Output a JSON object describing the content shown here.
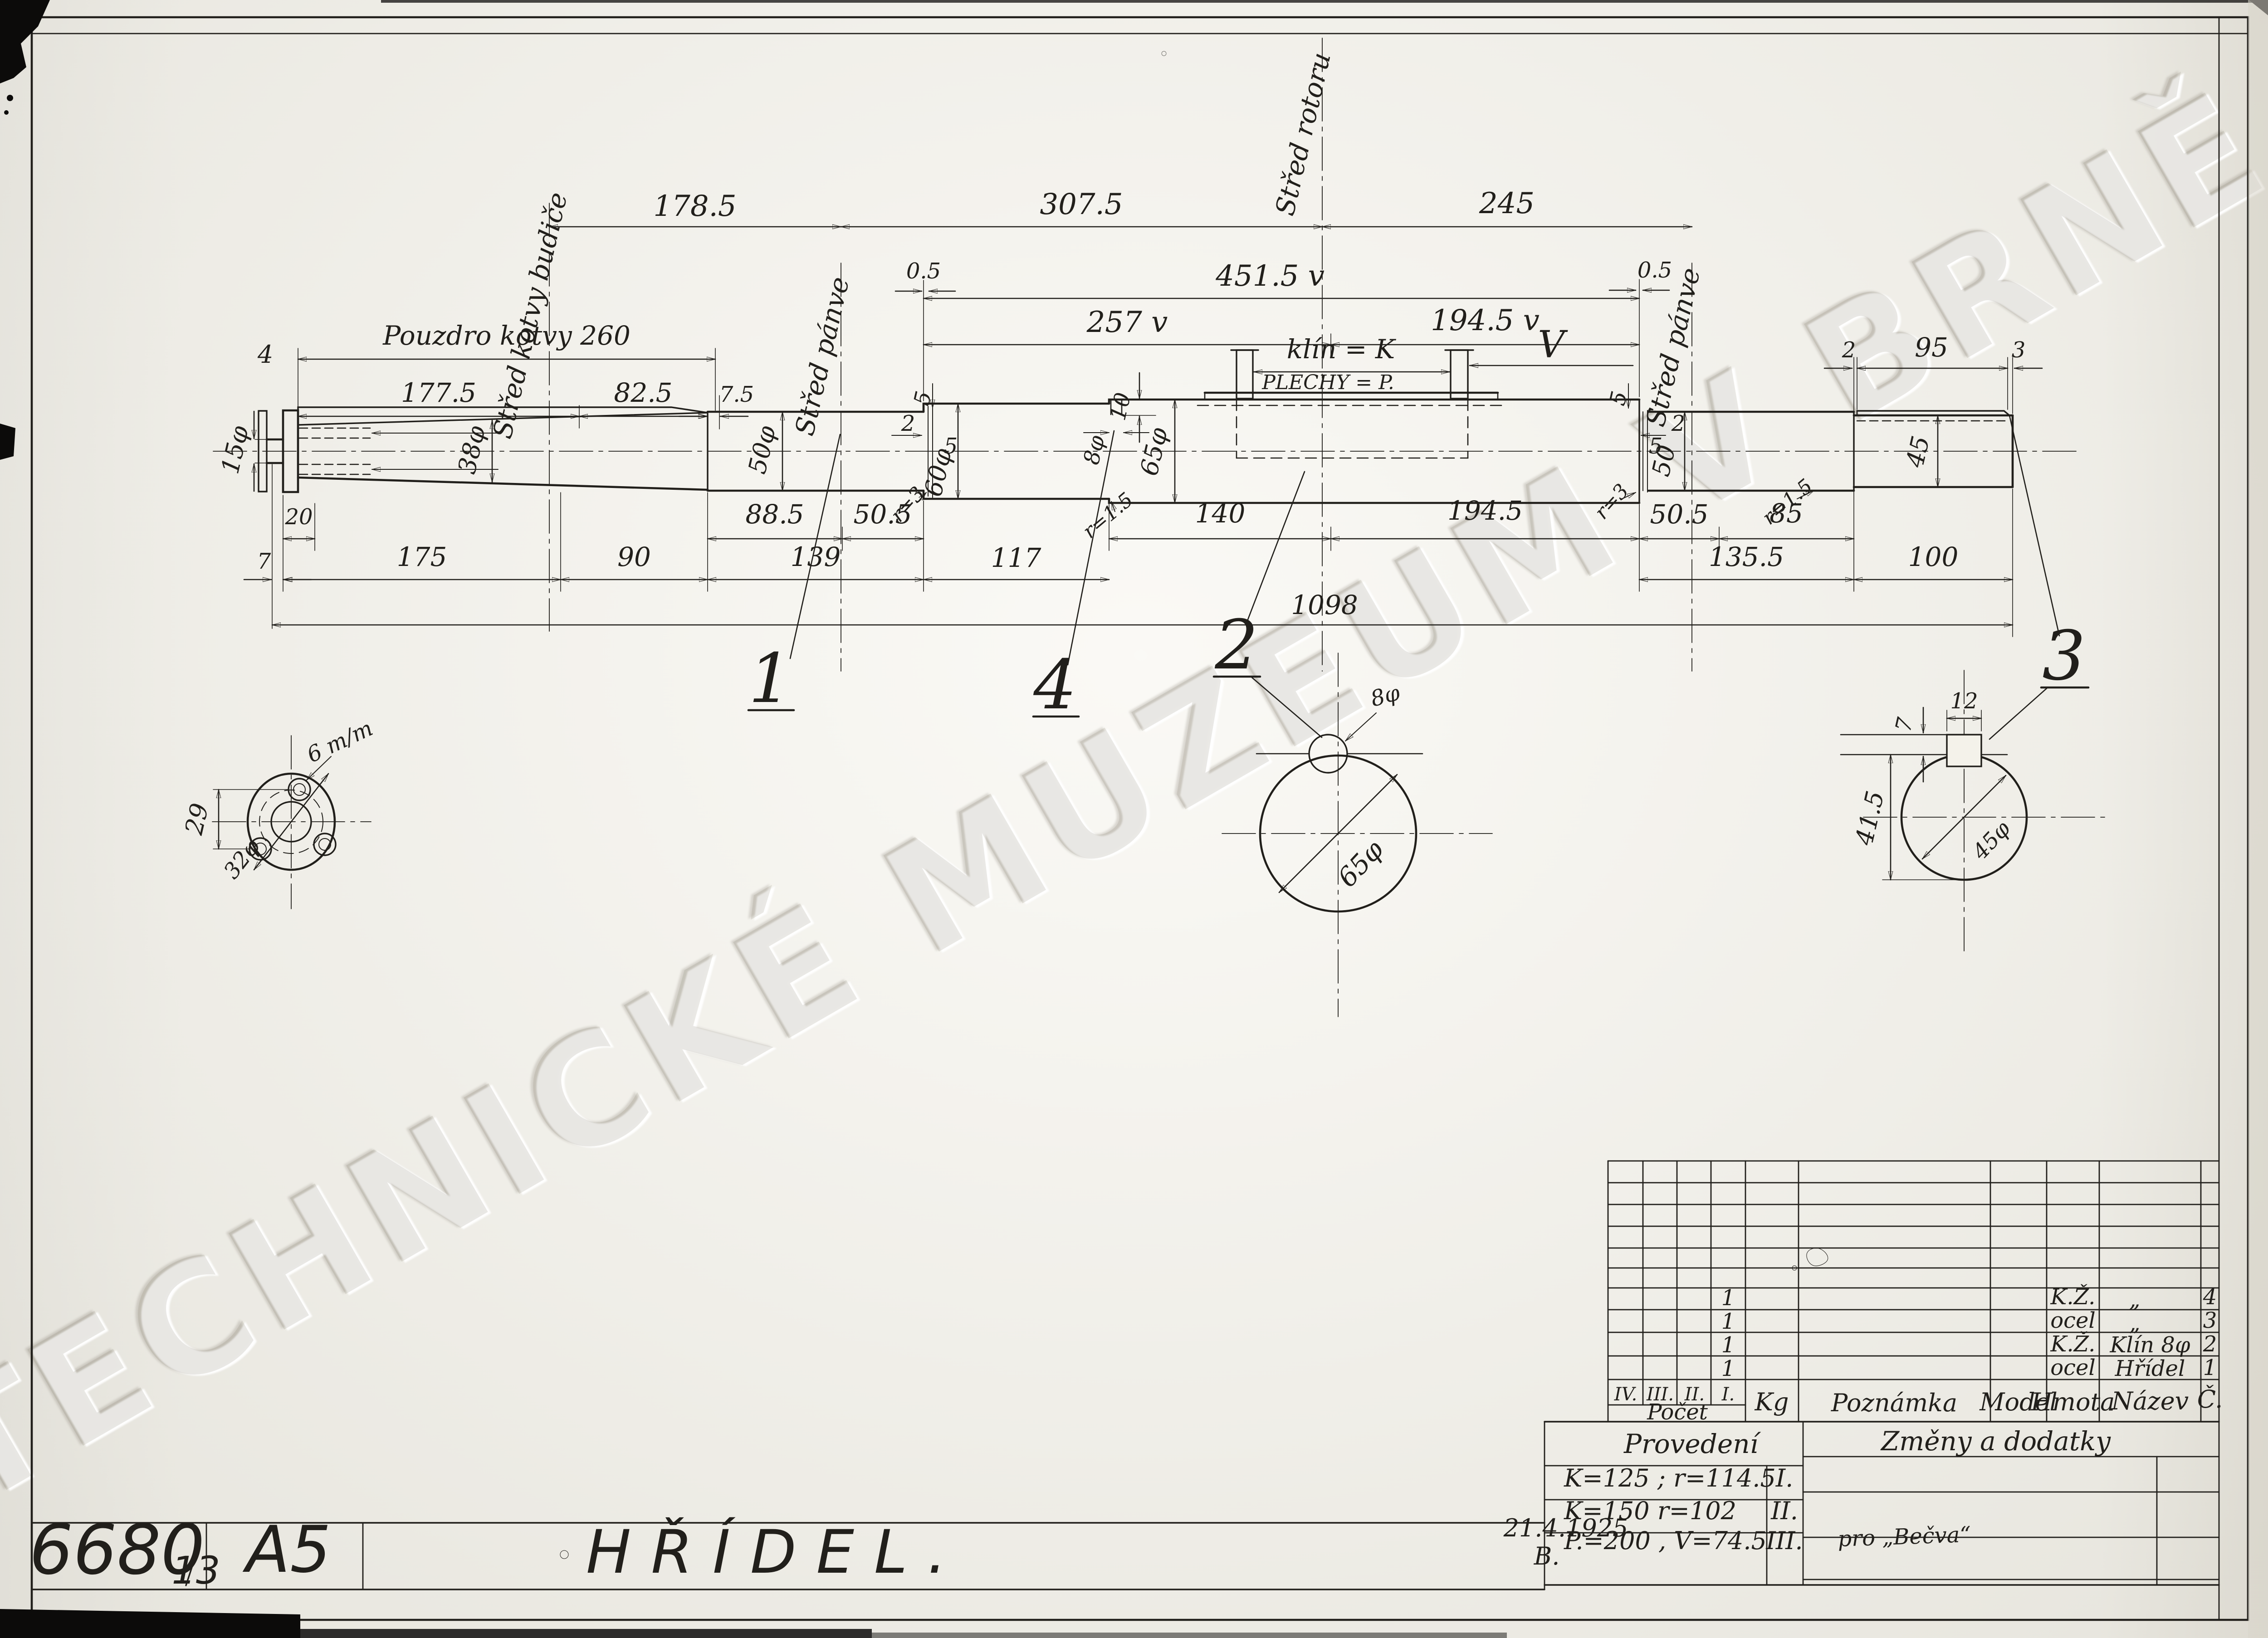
{
  "sheet": {
    "number": "6680",
    "number_suffix": "13",
    "format": "A5",
    "title": "HŘÍDEL.",
    "date": "21.4.1925",
    "signature": "B."
  },
  "watermark": {
    "text": "TECHNICKÉ MUZEUM V BRNĚ"
  },
  "axes": {
    "budic": "Střed kotvy budiče",
    "panve_l": "Střed pánve",
    "rotor": "Střed rotoru",
    "panve_r": "Střed pánve"
  },
  "top_dims": {
    "d178": "178.5",
    "d307": "307.5",
    "d245": "245",
    "d451": "451.5 v",
    "d257": "257 v",
    "d194": "194.5 v",
    "pouzdro": "Pouzdro kotvy 260",
    "d177": "177.5",
    "d82": "82.5",
    "d7_5": "7.5",
    "d4": "4",
    "d05l": "0.5",
    "d05r": "0.5",
    "klin": "klín = K",
    "plechy": "PLECHY = P.",
    "v_mark": "V",
    "key2": "2",
    "key95": "95",
    "key3": "3"
  },
  "dia": {
    "d15": "15φ",
    "d38": "38φ",
    "d50l": "50φ",
    "d60": "60φ",
    "d65": "65φ",
    "d50r": "50",
    "d45": "45",
    "d10": "10",
    "d8": "8φ",
    "g2l": "2",
    "g5l1": "5",
    "g5l2": "5",
    "g5r1": "5",
    "g5r2": "5",
    "g2r": "2",
    "r3l": "r=3",
    "r3r": "r=3",
    "r15l": "r=1.5",
    "r15r": "r=1.5"
  },
  "bot_dims": {
    "d20": "20",
    "d885": "88.5",
    "d505a": "50.5",
    "d140": "140",
    "d1945": "194.5",
    "d505b": "50.5",
    "d85": "85",
    "d7": "7",
    "d175": "175",
    "d90": "90",
    "d139": "139",
    "d117": "117",
    "d1355": "135.5",
    "d100": "100",
    "d1098": "1098"
  },
  "balloons": {
    "b1": "1",
    "b2": "2",
    "b3": "3",
    "b4": "4"
  },
  "details": {
    "left": {
      "d29": "29",
      "d6mm": "6 m/m",
      "d32": "32φ"
    },
    "mid": {
      "d8": "8φ",
      "d65": "65φ"
    },
    "right": {
      "d12": "12",
      "d7": "7",
      "d415": "41.5",
      "d45": "45φ"
    }
  },
  "table": {
    "pocet": "Počet",
    "roman": [
      "IV.",
      "III.",
      "II.",
      "I."
    ],
    "kg": "Kg",
    "poznamka": "Poznámka",
    "model": "Model",
    "hmota": "Hmota",
    "nazev": "Název",
    "cislo": "Č.",
    "rows": [
      {
        "count": "1",
        "hmota": "K.Ž.",
        "nazev": "„",
        "cislo": "4"
      },
      {
        "count": "1",
        "hmota": "ocel",
        "nazev": "„",
        "cislo": "3"
      },
      {
        "count": "1",
        "hmota": "K.Ž.",
        "nazev": "Klín 8φ",
        "cislo": "2"
      },
      {
        "count": "1",
        "hmota": "ocel",
        "nazev": "Hřídel",
        "cislo": "1"
      }
    ]
  },
  "provedeni": {
    "title": "Provedení",
    "rows": [
      {
        "text": "K=125 ; r=114.5",
        "mark": "I."
      },
      {
        "text": "K=150  r=102",
        "mark": "II."
      },
      {
        "text": "P.=200 , V=74.5",
        "mark": "III."
      }
    ],
    "note": "pro „Bečva“"
  },
  "zmeny": {
    "title": "Změny a dodatky"
  }
}
